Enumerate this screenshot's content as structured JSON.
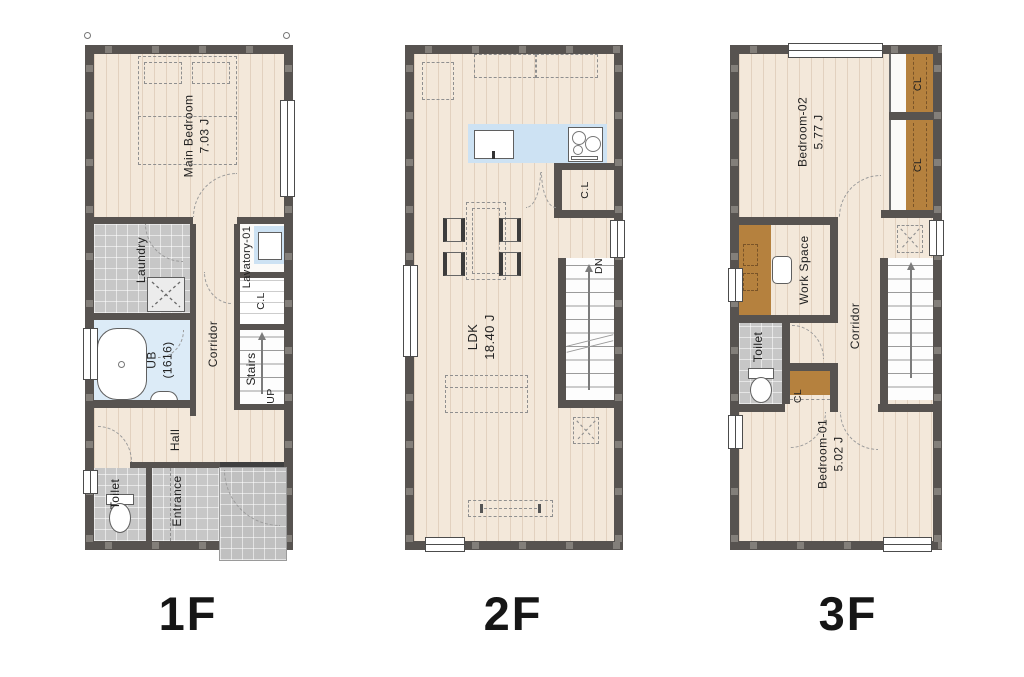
{
  "page": {
    "type": "architectural-floor-plan",
    "background": "#ffffff"
  },
  "colors": {
    "wall": "#575350",
    "floor": "#f3e8da",
    "tile_gray": "#c7c7c7",
    "bath_blue": "#dcebf7",
    "kitchen_blue": "#cde2f3",
    "closet_brown": "#b5813e",
    "stairs_white": "#fdfdfd",
    "dash_line": "#8f8f8f",
    "text": "#1d1d1d"
  },
  "floors": {
    "f1": {
      "label": "1F",
      "rooms": {
        "main_bedroom": {
          "name": "Main Bedroom",
          "size": "7.03 J"
        },
        "laundry": {
          "name": "Laundry"
        },
        "lavatory": {
          "name": "Lavatory-01"
        },
        "bath": {
          "name": "UB",
          "size": "(1616)"
        },
        "corridor": {
          "name": "Corridor"
        },
        "closet": {
          "name": "C.L"
        },
        "stairs": {
          "name": "Stairs",
          "direction": "UP"
        },
        "hall": {
          "name": "Hall"
        },
        "toilet": {
          "name": "Toilet"
        },
        "entrance": {
          "name": "Entrance"
        }
      }
    },
    "f2": {
      "label": "2F",
      "rooms": {
        "ldk": {
          "name": "LDK",
          "size": "18.40 J"
        },
        "closet": {
          "name": "C.L"
        },
        "stairs": {
          "direction": "DN"
        }
      }
    },
    "f3": {
      "label": "3F",
      "rooms": {
        "bedroom02": {
          "name": "Bedroom-02",
          "size": "5.77 J"
        },
        "closet_a": {
          "name": "CL"
        },
        "closet_b": {
          "name": "CL"
        },
        "workspace": {
          "name": "Work Space"
        },
        "corridor": {
          "name": "Corridor"
        },
        "toilet": {
          "name": "Toilet"
        },
        "closet_c": {
          "name": "CL"
        },
        "bedroom01": {
          "name": "Bedroom-01",
          "size": "5.02 J"
        }
      }
    }
  }
}
